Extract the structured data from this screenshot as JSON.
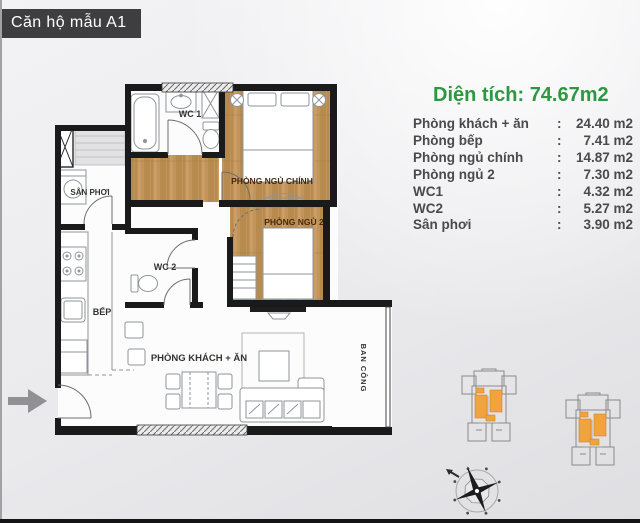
{
  "title": "Căn hộ mẫu A1",
  "info": {
    "area_label": "Diện tích:",
    "area_value": "74.67m2",
    "sep": ":",
    "rows": [
      {
        "label": "Phòng khách + ăn",
        "value": "24.40 m2"
      },
      {
        "label": "Phòng bếp",
        "value": "7.41 m2"
      },
      {
        "label": "Phòng ngủ chính",
        "value": "14.87 m2"
      },
      {
        "label": "Phòng ngủ 2",
        "value": "7.30 m2"
      },
      {
        "label": "WC1",
        "value": "4.32 m2"
      },
      {
        "label": "WC2",
        "value": "5.27 m2"
      },
      {
        "label": "Sân phơi",
        "value": "3.90 m2"
      }
    ]
  },
  "plan": {
    "labels": {
      "wc1": "WC 1",
      "wc2": "WC 2",
      "san_phoi": "SÂN PHƠI",
      "bep": "BẾP",
      "master_bedroom": "PHÒNG NGỦ CHÍNH",
      "bedroom2": "PHÒNG NGỦ 2",
      "living": "PHÒNG KHÁCH + ĂN",
      "balcony": "BAN CÔNG"
    }
  },
  "icons": {
    "entrance-arrow-icon": "right-arrow",
    "compass-rose-icon": "compass-rose",
    "keyplan": "building-footprint-with-highlighted-units"
  },
  "colors": {
    "accent_green": "#2e9741",
    "title_bg": "#3e3e40",
    "wall_black": "#1a1a1a",
    "wood_floor": "#c0945a",
    "keyplan_highlight": "#f2a33c"
  }
}
